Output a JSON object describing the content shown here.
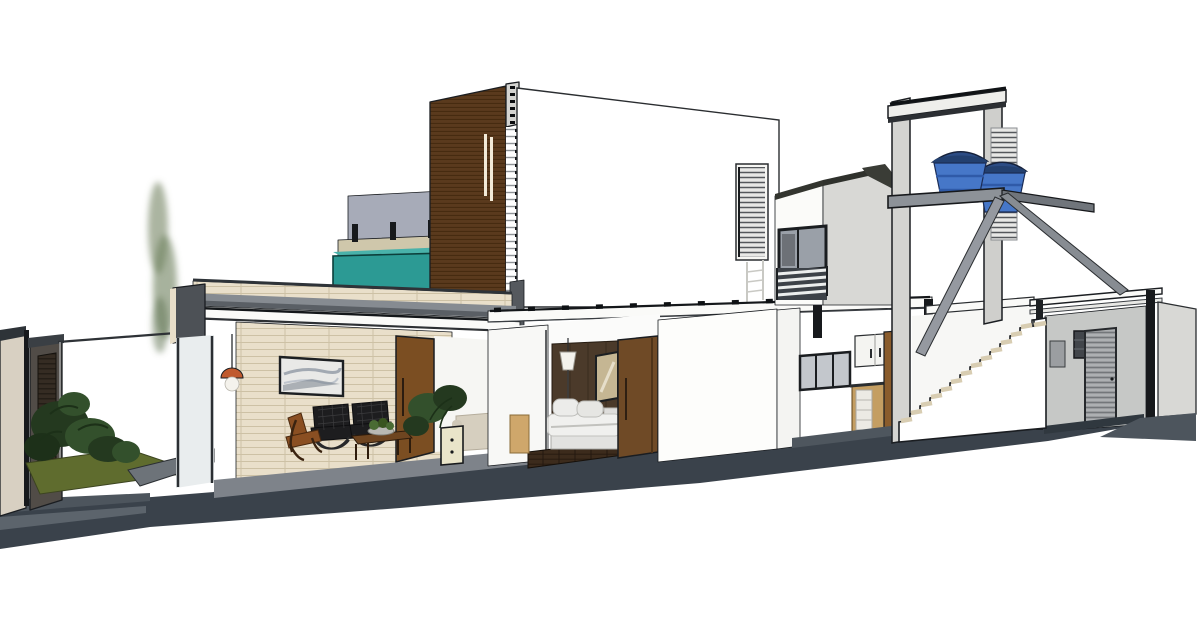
{
  "viewport": {
    "width": 1200,
    "height": 639,
    "background": "#ffffff",
    "view_label": "3d-section-view"
  },
  "palette": {
    "outline": "#1a1d21",
    "street": "#3a424b",
    "street_mid": "#4d555d",
    "street_light": "#5c646c",
    "floor_gray": "#7e838a",
    "ramp": "#6d7379",
    "grass": "#5f6c2e",
    "plant_dark": "#24391f",
    "plant_mid": "#33502c",
    "tree": "#7e8e6e",
    "stone": "#d8d0c2",
    "entry_wall": "#514c47",
    "entry_door": "#352c23",
    "brick": "#e9dfca",
    "brick_line": "#cdc1a5",
    "cap_dark": "#2e3338",
    "slab_top": "#868b91",
    "slab_front": "#5a5f65",
    "beam_white": "#fafaf8",
    "wood_tower": "#5a3a1d",
    "tower_cap": "#b9bcbe",
    "fin_white": "#f6f6f3",
    "white": "#ffffff",
    "lit": "#f6f6f3",
    "shade": "#d8d8d5",
    "gray_wall": "#c6c8c6",
    "bluegray": "#a7abb8",
    "bluegray_light": "#c3c6cf",
    "concrete": "#cfc7ab",
    "teal": "#2c9a94",
    "teal_top": "#49b2aa",
    "glass_dark": "#6d7177",
    "glass_mid": "#9aa0a8",
    "door_wood": "#7b4e22",
    "panel_wood": "#8a5c2c",
    "art": "#e9e9e7",
    "copper": "#c05a2e",
    "globe": "#f4f2ec",
    "leather": "#1d1d1f",
    "lounge": "#8a4f22",
    "table": "#6e4520",
    "planter": "#e9e4c9",
    "sofa": "#d6cfbf",
    "headboard": "#4b3a2a",
    "plank": "#3c2b1c",
    "wardrobe": "#6f4a26",
    "wood_light": "#cfa76b",
    "bed": "#f0f0ee",
    "bed_base": "#e2e2e0",
    "tank": "#4677c8",
    "tank_dark": "#23406f",
    "tank_mid": "#2c4c84",
    "tread": "#d8cdb2",
    "louver": "#adb0b2",
    "rail_bg": "#3d4248",
    "metal": "#9599a0",
    "door_light": "#e4e4e1",
    "drawer": "#eceae4",
    "kwood": "#c49e62",
    "frame_dark": "#1a1d20",
    "post": "#17191c",
    "col_light": "#d4d4d1"
  },
  "elements": {
    "scene": "residence-longitudinal-section",
    "street": "street-and-sidewalk",
    "garden": "entry-courtyard-garden",
    "living": "living-room",
    "pool": "rooftop-pool-volume",
    "tower": "timber-slat-tower",
    "facade": "upper-white-facade",
    "beam": "first-floor-slab-beam",
    "bedroom": "bedroom-suite",
    "balcony": "balcony-volume",
    "kitchen": "kitchen",
    "tanks": "water-tank-tower",
    "stairs": "external-staircase",
    "garage": "garage-block"
  }
}
